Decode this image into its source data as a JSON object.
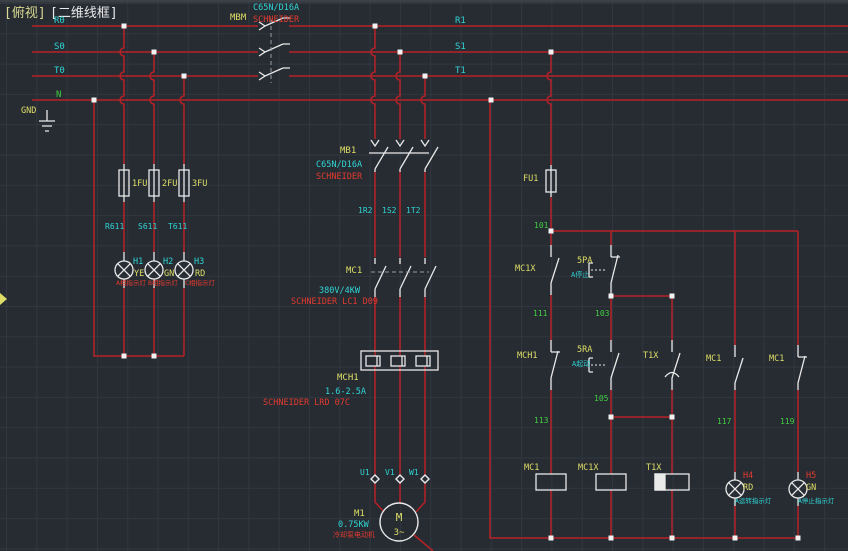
{
  "colors": {
    "bg": "#272c33",
    "grid": "#313740",
    "topstrip": "#42474e",
    "wire": "#b52127",
    "symbol": "#e9e9e9",
    "cyan": "#2fd5d5",
    "yellow": "#dede66",
    "titleYellow": "#d8d890",
    "green": "#41cf41",
    "redText": "#e23a2e",
    "dashed": "#979da3",
    "grip": "#f2f2f2",
    "white": "#e9e9e9"
  },
  "labels": [
    {
      "id": "title-view",
      "text": "[俯视]",
      "color": "titleYellow",
      "x": 4,
      "y": 17,
      "size": 13
    },
    {
      "id": "title-style",
      "text": "[二维线框]",
      "color": "white",
      "x": 50,
      "y": 17,
      "size": 13
    },
    {
      "id": "bus-r0",
      "text": "R0",
      "color": "cyan",
      "x": 54,
      "y": 23,
      "size": 9
    },
    {
      "id": "bus-s0",
      "text": "S0",
      "color": "cyan",
      "x": 54,
      "y": 49,
      "size": 9
    },
    {
      "id": "bus-t0",
      "text": "T0",
      "color": "cyan",
      "x": 54,
      "y": 73,
      "size": 9
    },
    {
      "id": "bus-n",
      "text": "N",
      "color": "green",
      "x": 56,
      "y": 97,
      "size": 9
    },
    {
      "id": "gnd-label",
      "text": "GND",
      "color": "yellow",
      "x": 21,
      "y": 113,
      "size": 8.5
    },
    {
      "id": "bus-r1",
      "text": "R1",
      "color": "cyan",
      "x": 455,
      "y": 23,
      "size": 9
    },
    {
      "id": "bus-s1",
      "text": "S1",
      "color": "cyan",
      "x": 455,
      "y": 49,
      "size": 9
    },
    {
      "id": "bus-t1",
      "text": "T1",
      "color": "cyan",
      "x": 455,
      "y": 73,
      "size": 9
    },
    {
      "id": "mbm-tag",
      "text": "MBM",
      "color": "yellow",
      "x": 230,
      "y": 20,
      "size": 9
    },
    {
      "id": "mbm-model",
      "text": "C65N/D16A",
      "color": "cyan",
      "x": 253,
      "y": 10,
      "size": 8.5
    },
    {
      "id": "mbm-brand",
      "text": "SCHNEIDER",
      "color": "redText",
      "x": 253,
      "y": 22,
      "size": 8.5
    },
    {
      "id": "fuse1-tag",
      "text": "1FU",
      "color": "yellow",
      "x": 132,
      "y": 186,
      "size": 8.5
    },
    {
      "id": "fuse2-tag",
      "text": "2FU",
      "color": "yellow",
      "x": 162,
      "y": 186,
      "size": 8.5
    },
    {
      "id": "fuse3-tag",
      "text": "3FU",
      "color": "yellow",
      "x": 192,
      "y": 186,
      "size": 8.5
    },
    {
      "id": "wire-r611",
      "text": "R611",
      "color": "cyan",
      "x": 105,
      "y": 229,
      "size": 8
    },
    {
      "id": "wire-s611",
      "text": "S611",
      "color": "cyan",
      "x": 138,
      "y": 229,
      "size": 8
    },
    {
      "id": "wire-t611",
      "text": "T611",
      "color": "cyan",
      "x": 168,
      "y": 229,
      "size": 8
    },
    {
      "id": "lamp-h1-tag",
      "text": "H1",
      "color": "cyan",
      "x": 133,
      "y": 264,
      "size": 8.5
    },
    {
      "id": "lamp-h1-color",
      "text": "YE",
      "color": "yellow",
      "x": 134,
      "y": 276,
      "size": 8.5
    },
    {
      "id": "lamp-h2-tag",
      "text": "H2",
      "color": "cyan",
      "x": 163,
      "y": 264,
      "size": 8.5
    },
    {
      "id": "lamp-h2-color",
      "text": "GN",
      "color": "yellow",
      "x": 164,
      "y": 276,
      "size": 8.5
    },
    {
      "id": "lamp-h3-tag",
      "text": "H3",
      "color": "cyan",
      "x": 194,
      "y": 264,
      "size": 8.5
    },
    {
      "id": "lamp-h3-color",
      "text": "RD",
      "color": "yellow",
      "x": 195,
      "y": 276,
      "size": 8.5
    },
    {
      "id": "lamp-h1-desc",
      "text": "A相指示灯",
      "color": "redText",
      "x": 116,
      "y": 285,
      "size": 6.5
    },
    {
      "id": "lamp-h2-desc",
      "text": "B相指示灯",
      "color": "redText",
      "x": 148,
      "y": 285,
      "size": 6.5
    },
    {
      "id": "lamp-h3-desc",
      "text": "C相指示灯",
      "color": "redText",
      "x": 185,
      "y": 285,
      "size": 6.5
    },
    {
      "id": "mb1-tag",
      "text": "MB1",
      "color": "yellow",
      "x": 340,
      "y": 153,
      "size": 9
    },
    {
      "id": "mb1-model",
      "text": "C65N/D16A",
      "color": "cyan",
      "x": 316,
      "y": 167,
      "size": 8.5
    },
    {
      "id": "mb1-brand",
      "text": "SCHNEIDER",
      "color": "redText",
      "x": 316,
      "y": 179,
      "size": 8.5
    },
    {
      "id": "wire-1r2",
      "text": "1R2",
      "color": "cyan",
      "x": 358,
      "y": 213,
      "size": 8
    },
    {
      "id": "wire-1s2",
      "text": "1S2",
      "color": "cyan",
      "x": 382,
      "y": 213,
      "size": 8
    },
    {
      "id": "wire-1t2",
      "text": "1T2",
      "color": "cyan",
      "x": 406,
      "y": 213,
      "size": 8
    },
    {
      "id": "mc1-tag",
      "text": "MC1",
      "color": "yellow",
      "x": 346,
      "y": 273,
      "size": 9
    },
    {
      "id": "mc1-rating",
      "text": "380V/4KW",
      "color": "cyan",
      "x": 319,
      "y": 293,
      "size": 8.5
    },
    {
      "id": "mc1-brand",
      "text": "SCHNEIDER LC1 D09",
      "color": "redText",
      "x": 291,
      "y": 304,
      "size": 8.5
    },
    {
      "id": "mch1-tag",
      "text": "MCH1",
      "color": "yellow",
      "x": 337,
      "y": 380,
      "size": 9
    },
    {
      "id": "mch1-rating",
      "text": "1.6-2.5A",
      "color": "cyan",
      "x": 325,
      "y": 394,
      "size": 8.5
    },
    {
      "id": "mch1-brand",
      "text": "SCHNEIDER LRD 07C",
      "color": "redText",
      "x": 263,
      "y": 405,
      "size": 8.5
    },
    {
      "id": "term-u1",
      "text": "U1",
      "color": "cyan",
      "x": 360,
      "y": 475,
      "size": 8
    },
    {
      "id": "term-v1",
      "text": "V1",
      "color": "cyan",
      "x": 385,
      "y": 475,
      "size": 8
    },
    {
      "id": "term-w1",
      "text": "W1",
      "color": "cyan",
      "x": 409,
      "y": 475,
      "size": 8
    },
    {
      "id": "motor-tag",
      "text": "M1",
      "color": "yellow",
      "x": 354,
      "y": 516,
      "size": 9
    },
    {
      "id": "motor-rating",
      "text": "0.75KW",
      "color": "cyan",
      "x": 338,
      "y": 527,
      "size": 8.5
    },
    {
      "id": "motor-desc",
      "text": "冷却泵电动机",
      "color": "redText",
      "x": 333,
      "y": 537,
      "size": 7
    },
    {
      "id": "motor-m",
      "text": "M",
      "color": "yellow",
      "x": 399,
      "y": 521,
      "size": 11,
      "anchor": "middle"
    },
    {
      "id": "motor-phase",
      "text": "3~",
      "color": "yellow",
      "x": 399,
      "y": 535,
      "size": 9,
      "anchor": "middle"
    },
    {
      "id": "fu1-tag",
      "text": "FU1",
      "color": "yellow",
      "x": 523,
      "y": 181,
      "size": 8.5
    },
    {
      "id": "wire-101",
      "text": "101",
      "color": "green",
      "x": 534,
      "y": 228,
      "size": 8
    },
    {
      "id": "wire-111",
      "text": "111",
      "color": "green",
      "x": 533,
      "y": 316,
      "size": 8
    },
    {
      "id": "wire-103",
      "text": "103",
      "color": "green",
      "x": 595,
      "y": 316,
      "size": 8
    },
    {
      "id": "wire-113",
      "text": "113",
      "color": "green",
      "x": 534,
      "y": 423,
      "size": 8
    },
    {
      "id": "wire-105",
      "text": "105",
      "color": "green",
      "x": 594,
      "y": 401,
      "size": 8
    },
    {
      "id": "wire-117",
      "text": "117",
      "color": "green",
      "x": 717,
      "y": 424,
      "size": 8
    },
    {
      "id": "wire-119",
      "text": "119",
      "color": "green",
      "x": 780,
      "y": 424,
      "size": 8
    },
    {
      "id": "mc1x-contact-tag",
      "text": "MC1X",
      "color": "yellow",
      "x": 515,
      "y": 271,
      "size": 8.5
    },
    {
      "id": "btn-5pa-tag",
      "text": "5PA",
      "color": "yellow",
      "x": 577,
      "y": 263,
      "size": 8.5
    },
    {
      "id": "btn-5pa-desc",
      "text": "A停止",
      "color": "cyan",
      "x": 571,
      "y": 277,
      "size": 7
    },
    {
      "id": "mch1-contact-tag",
      "text": "MCH1",
      "color": "yellow",
      "x": 517,
      "y": 358,
      "size": 8.5
    },
    {
      "id": "btn-5ra-tag",
      "text": "5RA",
      "color": "yellow",
      "x": 577,
      "y": 352,
      "size": 8.5
    },
    {
      "id": "btn-5ra-desc",
      "text": "A起动",
      "color": "cyan",
      "x": 572,
      "y": 366,
      "size": 7
    },
    {
      "id": "t1x-contact-tag",
      "text": "T1X",
      "color": "yellow",
      "x": 643,
      "y": 358,
      "size": 8.5
    },
    {
      "id": "mc1-no-tag",
      "text": "MC1",
      "color": "yellow",
      "x": 706,
      "y": 361,
      "size": 8.5
    },
    {
      "id": "mc1-nc-tag",
      "text": "MC1",
      "color": "yellow",
      "x": 769,
      "y": 361,
      "size": 8.5
    },
    {
      "id": "coil-mc1-tag",
      "text": "MC1",
      "color": "yellow",
      "x": 524,
      "y": 470,
      "size": 8.5
    },
    {
      "id": "coil-mc1x-tag",
      "text": "MC1X",
      "color": "yellow",
      "x": 578,
      "y": 470,
      "size": 8.5
    },
    {
      "id": "coil-t1x-tag",
      "text": "T1X",
      "color": "yellow",
      "x": 646,
      "y": 470,
      "size": 8.5
    },
    {
      "id": "lamp-h4-tag",
      "text": "H4",
      "color": "redText",
      "x": 743,
      "y": 478,
      "size": 8.5
    },
    {
      "id": "lamp-h4-color",
      "text": "RD",
      "color": "yellow",
      "x": 743,
      "y": 490,
      "size": 8.5
    },
    {
      "id": "lamp-h4-desc",
      "text": "A运转指示灯",
      "color": "cyan",
      "x": 735,
      "y": 503,
      "size": 6.5
    },
    {
      "id": "lamp-h5-tag",
      "text": "H5",
      "color": "redText",
      "x": 806,
      "y": 478,
      "size": 8.5
    },
    {
      "id": "lamp-h5-color",
      "text": "GN",
      "color": "yellow",
      "x": 806,
      "y": 490,
      "size": 8.5
    },
    {
      "id": "lamp-h5-desc",
      "text": "A停止指示灯",
      "color": "cyan",
      "x": 798,
      "y": 503,
      "size": 6.5
    }
  ]
}
